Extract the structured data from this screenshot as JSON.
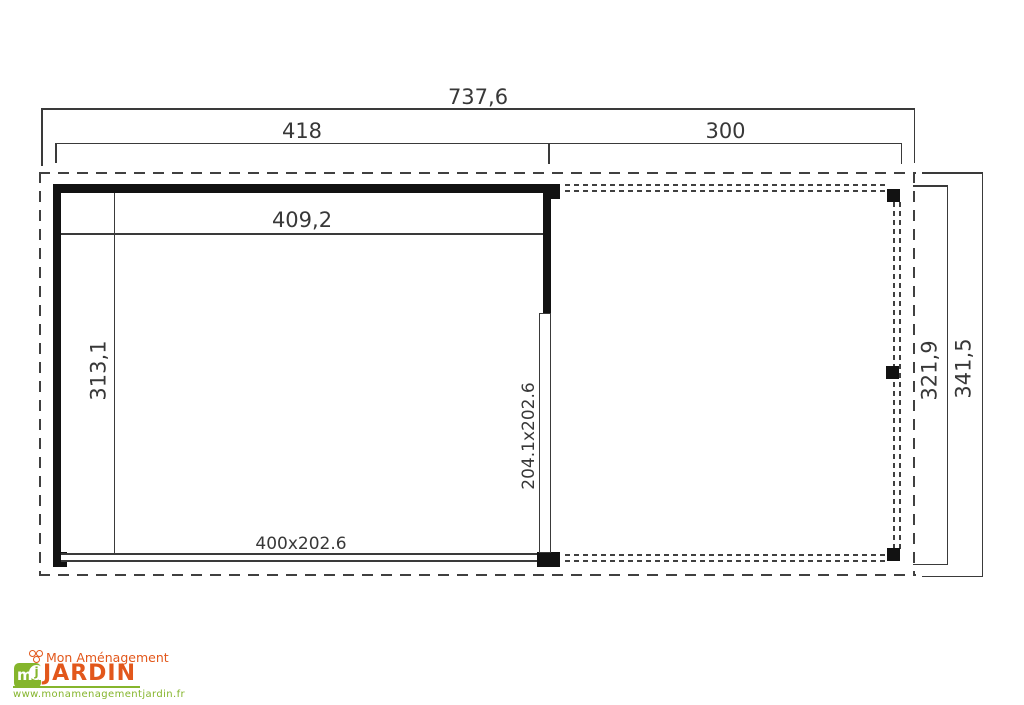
{
  "drawing": {
    "labels": {
      "total_width": "737,6",
      "cabin_width": "418",
      "canopy_width": "300",
      "inner_width": "409,2",
      "inner_depth": "313,1",
      "canopy_depth": "321,9",
      "total_depth": "341,5",
      "side_door": "204.1x202.6",
      "front_opening": "400x202.6"
    }
  },
  "logo": {
    "badge": "ma",
    "badge_accent": "j",
    "tagline": "Mon Aménagement",
    "brand": "JARDIN",
    "website": "www.monamenagementjardin.fr"
  },
  "colors": {
    "line": "#3a3a3a",
    "wall": "#121212",
    "brand_green": "#85b52c",
    "brand_orange": "#e2571b"
  }
}
